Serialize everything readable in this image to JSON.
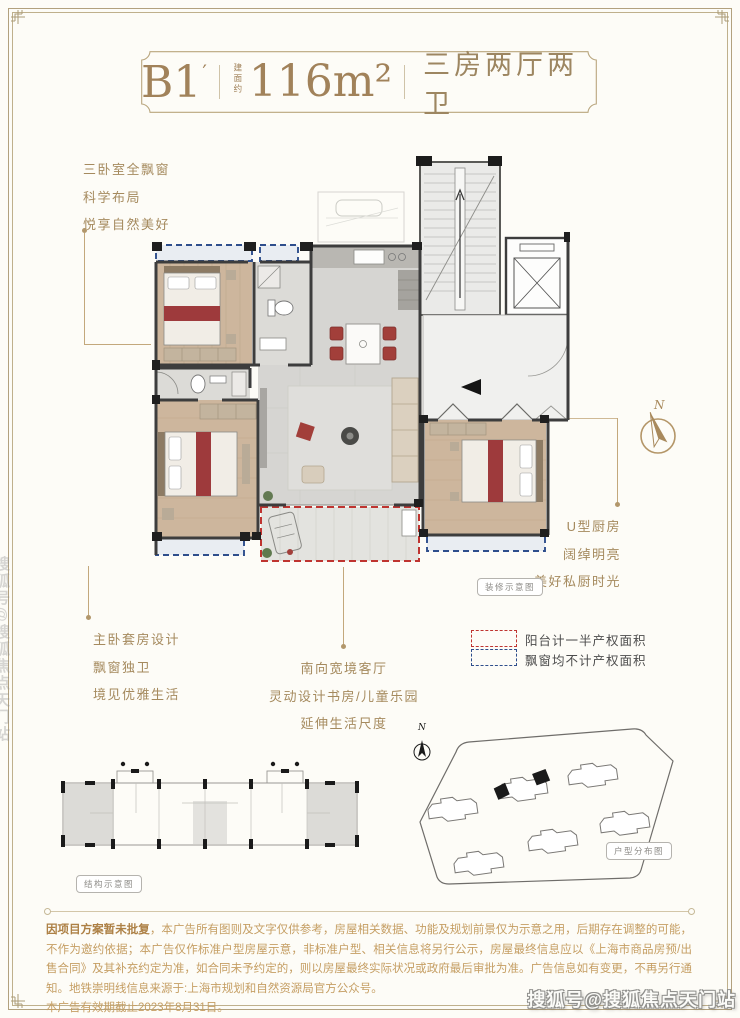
{
  "header": {
    "unit": "B1",
    "prime": "′",
    "area_label": "建面约",
    "area": "116m²",
    "rooms": "三房两厅两卫"
  },
  "annotations": {
    "left_top": [
      "三卧室全飘窗",
      "科学布局",
      "悦享自然美好"
    ],
    "bottom_left": [
      "主卧套房设计",
      "飘窗独卫",
      "境见优雅生活"
    ],
    "bottom_center": [
      "南向宽境客厅",
      "灵动设计书房/儿童乐园",
      "延伸生活尺度"
    ],
    "right": [
      "U型厨房",
      "阔绰明亮",
      "美好私厨时光"
    ]
  },
  "legend": [
    {
      "label": "阳台计一半产权面积",
      "color": "#bf3430",
      "style": "red-dashed"
    },
    {
      "label": "飘窗均不计产权面积",
      "color": "#2e4e8c",
      "style": "blue-dashed"
    }
  ],
  "captions": {
    "floorplan": "装修示意图",
    "structure": "结构示意图",
    "siteplan": "户型分布图"
  },
  "compass": {
    "label": "N"
  },
  "disclaimer": {
    "lead": "因项目方案暂未批复",
    "body": "，本广告所有图则及文字仅供参考，房屋相关数据、功能及规划前景仅为示意之用，后期存在调整的可能，不作为邀约依据；本广告仅作标准户型房屋示意，非标准户型、相关信息将另行公示，房屋最终信息应以《上海市商品房预/出售合同》及其补充约定为准，如合同未予约定的，则以房屋最终实际状况或政府最后审批为准。广告信息如有变更，不再另行通知。地铁崇明线信息来源于:上海市规划和自然资源局官方公众号。",
    "expiry": "本广告有效期截止2023年8月31日。"
  },
  "watermark": {
    "text": "搜狐号@搜狐焦点天门站"
  },
  "colors": {
    "gold": "#a58a5e",
    "balcony_red": "#bf3430",
    "baywindow_blue": "#2e4e8c"
  }
}
